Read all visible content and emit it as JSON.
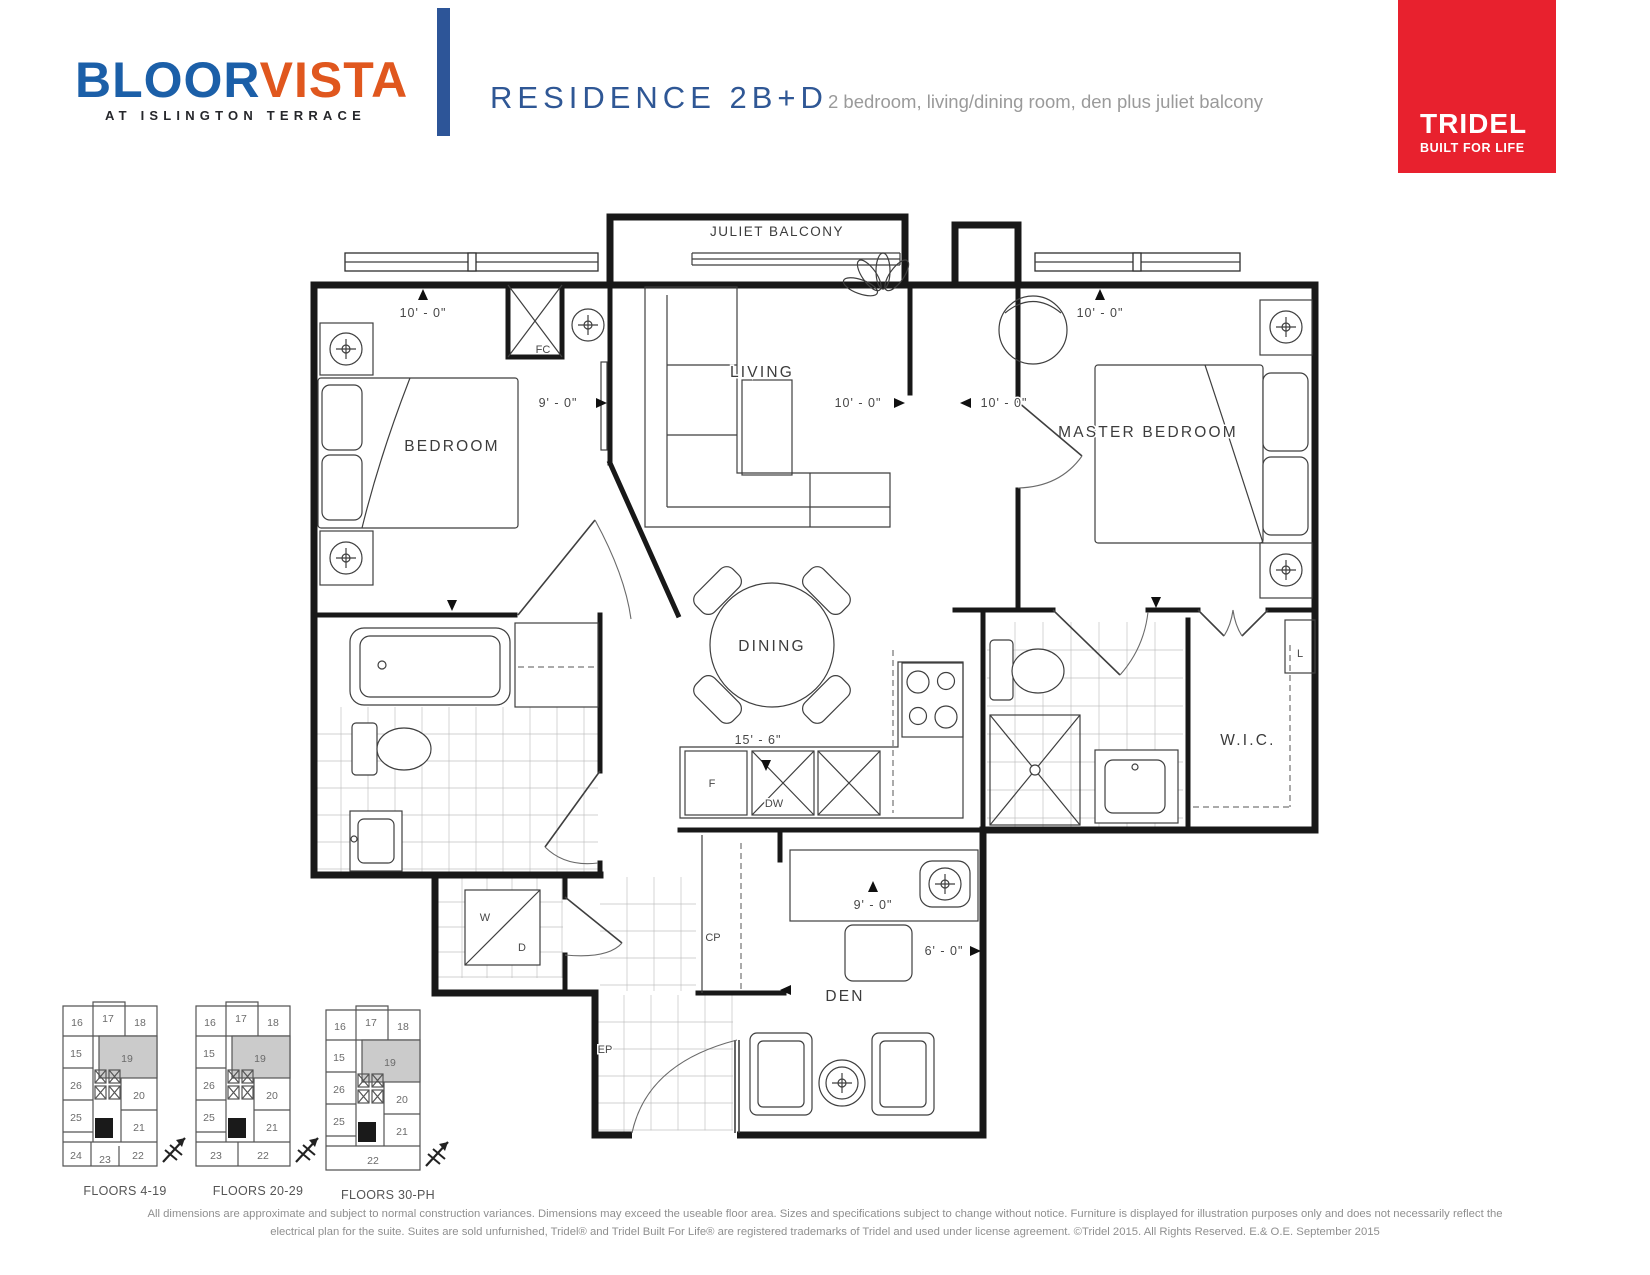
{
  "header": {
    "logo": {
      "word1": "BLOOR",
      "word2": "VISTA",
      "tagline": "AT ISLINGTON TERRACE"
    },
    "title": "RESIDENCE 2B+D",
    "subtitle": "2 bedroom, living/dining room, den plus juliet balcony",
    "brand": {
      "name": "TRIDEL",
      "tagline": "BUILT FOR LIFE"
    }
  },
  "colors": {
    "logo_blue": "#1b5fa8",
    "logo_orange": "#e0571e",
    "divider_blue": "#2d5598",
    "title_blue": "#2f5795",
    "brand_red": "#e8212e",
    "wall_black": "#181818",
    "keyplan_highlight": "#cbcbcb"
  },
  "floorplan": {
    "balcony_label": "JULIET BALCONY",
    "rooms": {
      "bedroom": "BEDROOM",
      "living": "LIVING",
      "master": "MASTER BEDROOM",
      "dining": "DINING",
      "wic": "W.I.C.",
      "den": "DEN"
    },
    "fixtures": {
      "fc": "FC",
      "f": "F",
      "dw": "DW",
      "cp": "CP",
      "ep": "EP",
      "w": "W",
      "d": "D",
      "l": "L"
    },
    "dims": {
      "bedroom_top": "10' - 0\"",
      "bedroom_right": "9' - 0\"",
      "living": "10' - 0\"",
      "master_left": "10' - 0\"",
      "master_top": "10' - 0\"",
      "kitchen": "15' - 6\"",
      "den_desk": "9' - 0\"",
      "den": "6' - 0\""
    }
  },
  "keyplans": {
    "highlighted_unit": "19",
    "top_units": [
      "16",
      "17",
      "18"
    ],
    "mid_rows": [
      [
        "15",
        "19"
      ],
      [
        "26",
        "20"
      ],
      [
        "25",
        "21"
      ]
    ],
    "plans": [
      {
        "label": "FLOORS 4-19",
        "bottom_units": [
          "24",
          "23",
          "22"
        ]
      },
      {
        "label": "FLOORS 20-29",
        "bottom_units": [
          "23",
          "22"
        ]
      },
      {
        "label": "FLOORS 30-PH",
        "bottom_units": [
          "22"
        ]
      }
    ]
  },
  "disclaimer": {
    "line1": "All dimensions are approximate and subject to normal construction variances.  Dimensions may exceed the useable floor area.  Sizes and specifications subject to change without notice.  Furniture is displayed for illustration purposes only and does not necessarily reflect the",
    "line2": "electrical plan for the suite.  Suites are sold unfurnished, Tridel® and Tridel Built For Life® are registered trademarks of Tridel and used under license agreement. ©Tridel 2015. All Rights Reserved. E.& O.E.  September 2015"
  }
}
